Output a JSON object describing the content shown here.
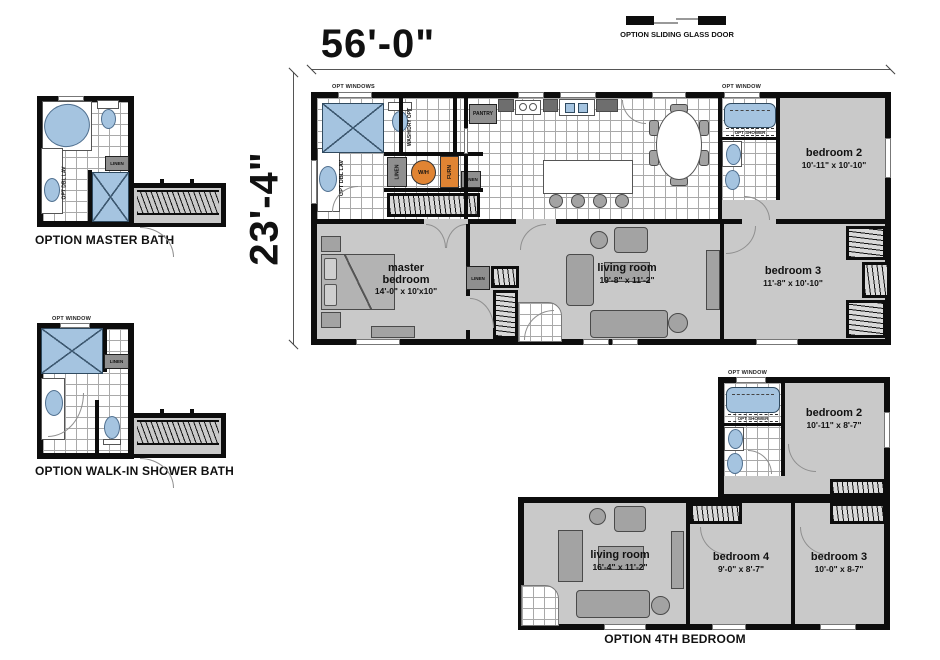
{
  "legend": {
    "sliding_door_label": "OPTION SLIDING GLASS DOOR"
  },
  "dims": {
    "width_label": "56'-0\"",
    "height_label": "23'-4\""
  },
  "labels": {
    "opt_windows": "OPT WINDOWS",
    "opt_window": "OPT WINDOW",
    "pantry": "PANTRY",
    "wash_dry_opt": "WASH/DRY OPT",
    "linen": "LINEN",
    "opt_dbl_lav": "OPT DBL LAV",
    "opt_shower": "OPT SHOWER",
    "wh": "W/H",
    "furn": "FURN"
  },
  "main_plan": {
    "master_bedroom_name": "master bedroom",
    "master_bedroom_dims": "14'-0\" x 10'x10\"",
    "living_room_name": "living room",
    "living_room_dims": "19'-8\" x 11'-2\"",
    "bedroom2_name": "bedroom 2",
    "bedroom2_dims": "10'-11\" x 10'-10\"",
    "bedroom3_name": "bedroom 3",
    "bedroom3_dims": "11'-8\" x 10'-10\""
  },
  "option_master_bath": {
    "title": "OPTION MASTER BATH"
  },
  "option_walkin_bath": {
    "title": "OPTION WALK-IN SHOWER BATH"
  },
  "option_4th_bedroom": {
    "title": "OPTION 4TH BEDROOM",
    "bedroom2_name": "bedroom 2",
    "bedroom2_dims": "10'-11\" x 8'-7\"",
    "living_room_name": "living room",
    "living_room_dims": "16'-4\" x 11'-2\"",
    "bedroom4_name": "bedroom 4",
    "bedroom4_dims": "9'-0\" x 8'-7\"",
    "bedroom3_name": "bedroom 3",
    "bedroom3_dims": "10'-0\" x 8-7\""
  },
  "colors": {
    "wall": "#0d0d0d",
    "floor": "#c9c9c9",
    "blue": "#a5c4e0",
    "orange": "#e08433",
    "furn": "#a3a3a3"
  }
}
